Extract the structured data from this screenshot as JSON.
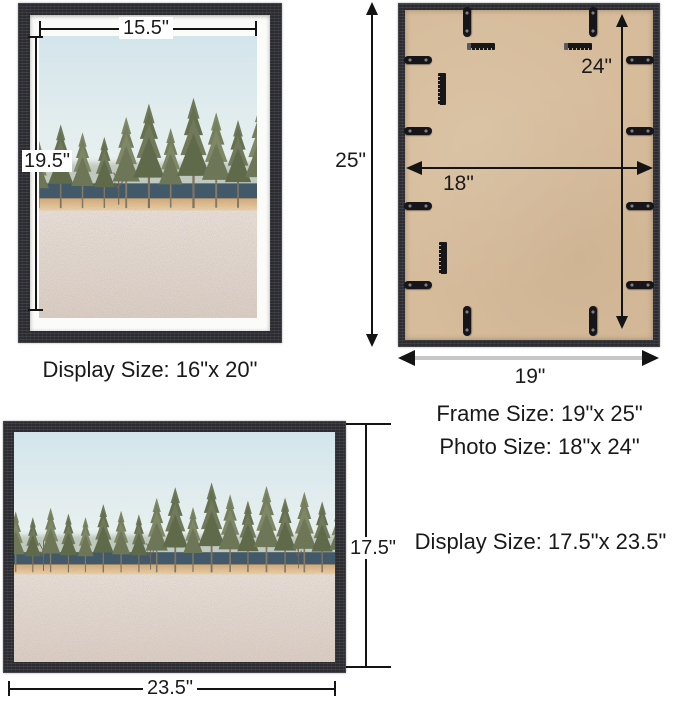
{
  "diagram": {
    "portrait_frame": {
      "width_dim": "15.5\"",
      "height_dim": "19.5\"",
      "caption": "Display Size: 16\"x 20\""
    },
    "back_view": {
      "outer_height_dim": "25\"",
      "inner_height_dim": "24\"",
      "inner_width_dim": "18\"",
      "outer_width_dim": "19\"",
      "frame_size": "Frame Size: 19\"x 25\"",
      "photo_size": "Photo Size: 18\"x 24\""
    },
    "landscape_frame": {
      "height_dim": "17.5\"",
      "width_dim": "23.5\"",
      "caption": "Display Size: 17.5\"x 23.5\""
    },
    "colors": {
      "frame": "#2b2b30",
      "mat": "#fbfbfa",
      "backing_board": "#d6bc9b",
      "dimension_line": "#141414",
      "outer_width_bar": "#c6c6c6",
      "text": "#1b1b1b"
    }
  }
}
